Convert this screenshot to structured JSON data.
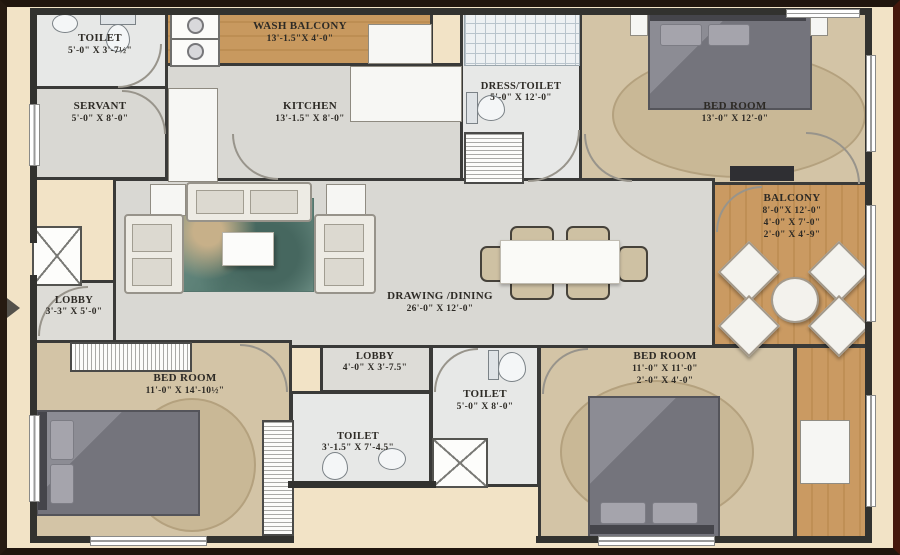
{
  "plan_type": "apartment-floor-plan",
  "palette": {
    "background": "#f2e3c6",
    "frame": "#20150d",
    "walls": "#3a3a38",
    "floor_light": "#d9d8d3",
    "floor_bedroom_tan": "#d3c4a6",
    "floor_wood_balcony": "#c8995f",
    "rug_teal": "#54796f",
    "bed_gray": "#74747c"
  },
  "rooms": {
    "toilet_tl": {
      "name": "TOILET",
      "dims": "5'-0\" X 3'-7½\""
    },
    "servant": {
      "name": "SERVANT",
      "dims": "5'-0\" X 8'-0\""
    },
    "wash_balcony": {
      "name": "WASH BALCONY",
      "dims": "13'-1.5\"X 4'-0\""
    },
    "kitchen": {
      "name": "KITCHEN",
      "dims": "13'-1.5\" X 8'-0\""
    },
    "dress_toilet": {
      "name": "DRESS/TOILET",
      "dims": "5'-0\" X 12'-0\""
    },
    "bedroom_tr": {
      "name": "BED ROOM",
      "dims": "13'-0\" X 12'-0\""
    },
    "balcony": {
      "name": "BALCONY",
      "dims": "8'-0\"X 12'-0\"",
      "dims2": "4'-0\" X 7'-0\"",
      "dims3": "2'-0\" X 4'-9\""
    },
    "drawing_dining": {
      "name": "DRAWING /DINING",
      "dims": "26'-0\" X 12'-0\""
    },
    "lobby_left": {
      "name": "LOBBY",
      "dims": "3'-3\" X 5'-0\""
    },
    "bedroom_bl": {
      "name": "BED ROOM",
      "dims": "11'-0\" X 14'-10½\""
    },
    "lobby_mid": {
      "name": "LOBBY",
      "dims": "4'-0\" X 3'-7.5\""
    },
    "toilet_mid": {
      "name": "TOILET",
      "dims": "3'-1.5\" X 7'-4.5\""
    },
    "toilet_b": {
      "name": "TOILET",
      "dims": "5'-0\" X 8'-0\""
    },
    "bedroom_br": {
      "name": "BED ROOM",
      "dims": "11'-0\" X 11'-0\"",
      "dims2": "2'-0\" X 4'-0\""
    }
  }
}
